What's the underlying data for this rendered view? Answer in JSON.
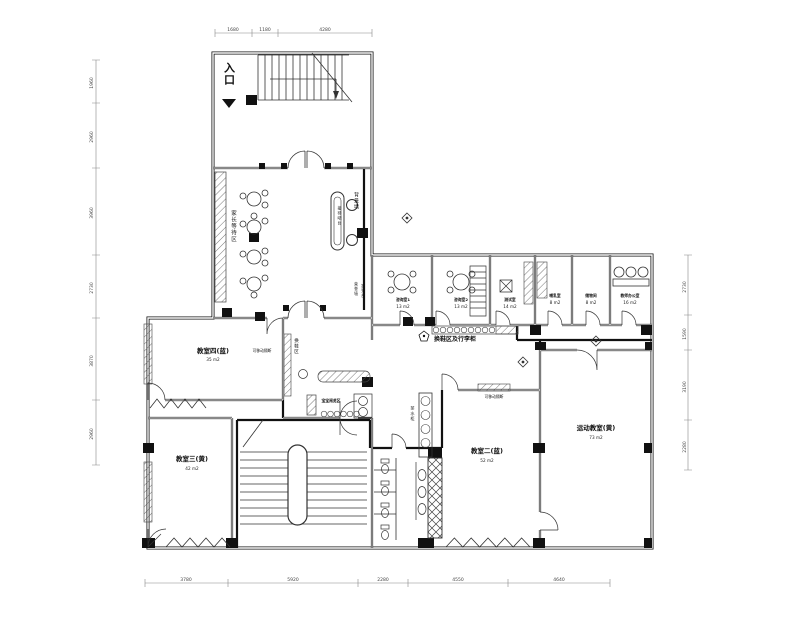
{
  "labels": {
    "entrance": "入口",
    "waiting_area": "家长等待区",
    "reception_desk": "接待吧台",
    "background_wall": "背景墙",
    "honor_wall": "荣誉墙",
    "signin_board": "签到台",
    "corridor_lockers": "换鞋区及行李柜",
    "shoe_change": "换鞋区",
    "movable_partition_1": "可移动隔断",
    "movable_partition_2": "可移动隔断",
    "baby_reading": "宝宝阅览区",
    "tea_cabinet": "茶水柜"
  },
  "rooms": {
    "consult1": {
      "name": "咨询室1",
      "area": "13 m2"
    },
    "consult2": {
      "name": "咨询室2",
      "area": "13 m2"
    },
    "test": {
      "name": "测试室",
      "area": "14 m2"
    },
    "nursing": {
      "name": "哺乳室",
      "area": "8 m2"
    },
    "storage": {
      "name": "储物间",
      "area": "8 m2"
    },
    "office": {
      "name": "教师办公室",
      "area": "16 m2"
    },
    "classroom4": {
      "name": "教室四(蓝)",
      "area": "35 m2"
    },
    "classroom3": {
      "name": "教室三(黄)",
      "area": "42 m2"
    },
    "classroom2": {
      "name": "教室二(蓝)",
      "area": "52 m2"
    },
    "sports": {
      "name": "运动教室(黄)",
      "area": "73 m2"
    }
  },
  "dimensions": {
    "top": [
      "1680",
      "1180",
      "4280"
    ],
    "bottom": [
      "3780",
      "5920",
      "2280",
      "4550",
      "4640"
    ],
    "left": [
      "1960",
      "2960",
      "3960",
      "2730",
      "3870",
      "2960"
    ],
    "right": [
      "2730",
      "1590",
      "3190",
      "2280"
    ]
  }
}
